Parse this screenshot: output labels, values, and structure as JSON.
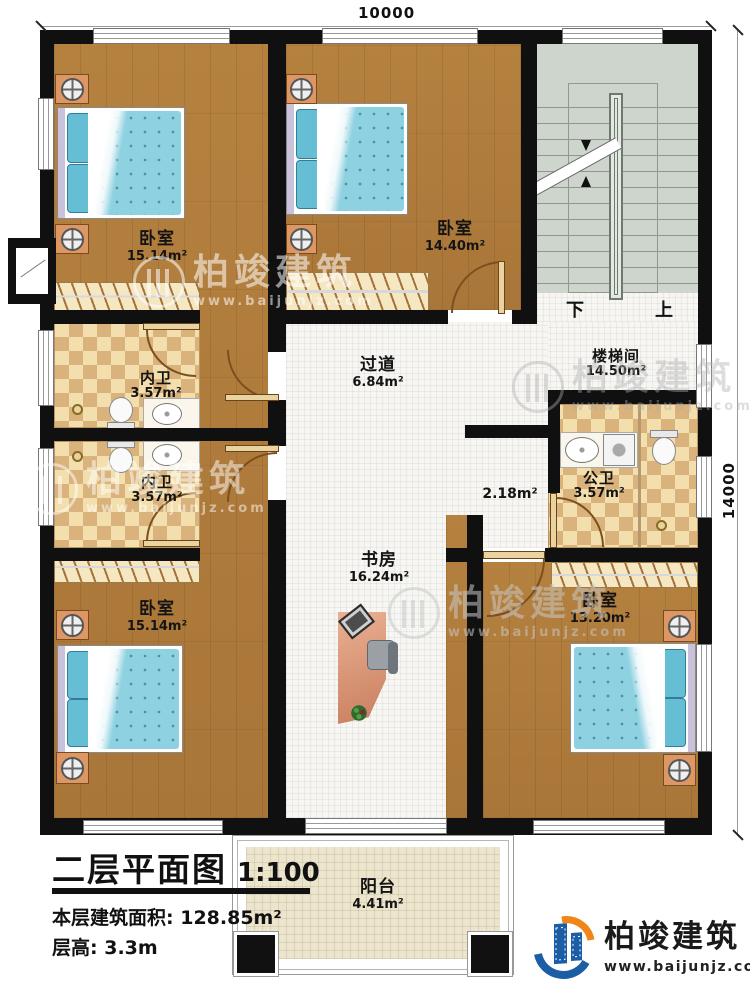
{
  "title_block": {
    "title": "二层平面图",
    "scale": "1:100",
    "area_label": "本层建筑面积:",
    "area_value": "128.85m²",
    "floor_height_label": "层高:",
    "floor_height_value": "3.3m"
  },
  "dimensions": {
    "top": "10000",
    "right": "14000"
  },
  "rooms": {
    "bedroom_top_left": {
      "name": "卧室",
      "area": "15.14m²"
    },
    "bedroom_top_middle": {
      "name": "卧室",
      "area": "14.40m²"
    },
    "stairwell": {
      "name": "楼梯间",
      "area": "14.50m²"
    },
    "corridor": {
      "name": "过道",
      "area": "6.84m²"
    },
    "ensuite_bath_1": {
      "name": "内卫",
      "area": "3.57m²"
    },
    "ensuite_bath_2": {
      "name": "内卫",
      "area": "3.57m²"
    },
    "public_bath": {
      "name": "公卫",
      "area": "3.57m²"
    },
    "small_hall": {
      "area": "2.18m²"
    },
    "study": {
      "name": "书房",
      "area": "16.24m²"
    },
    "bedroom_bottom_left": {
      "name": "卧室",
      "area": "15.14m²"
    },
    "bedroom_bottom_right": {
      "name": "卧室",
      "area": "13.20m²"
    },
    "balcony": {
      "name": "阳台",
      "area": "4.41m²"
    }
  },
  "stairs": {
    "down": "下",
    "up": "上"
  },
  "branding": {
    "company": "柏竣建筑",
    "website": "www.baijunjz.com"
  },
  "watermark": {
    "company": "柏竣建筑",
    "website": "www.baijunjz.com"
  },
  "colors": {
    "wall": "#101010",
    "wood": "#b07c3c",
    "tile_light": "#f3dfae",
    "tile_dark": "#d9b27c",
    "bed": "#8ed1e1",
    "stair": "#cdd5cc",
    "balcony_tile": "#ece5cb",
    "logo_blue": "#1b5ea6",
    "logo_orange": "#f08519"
  }
}
